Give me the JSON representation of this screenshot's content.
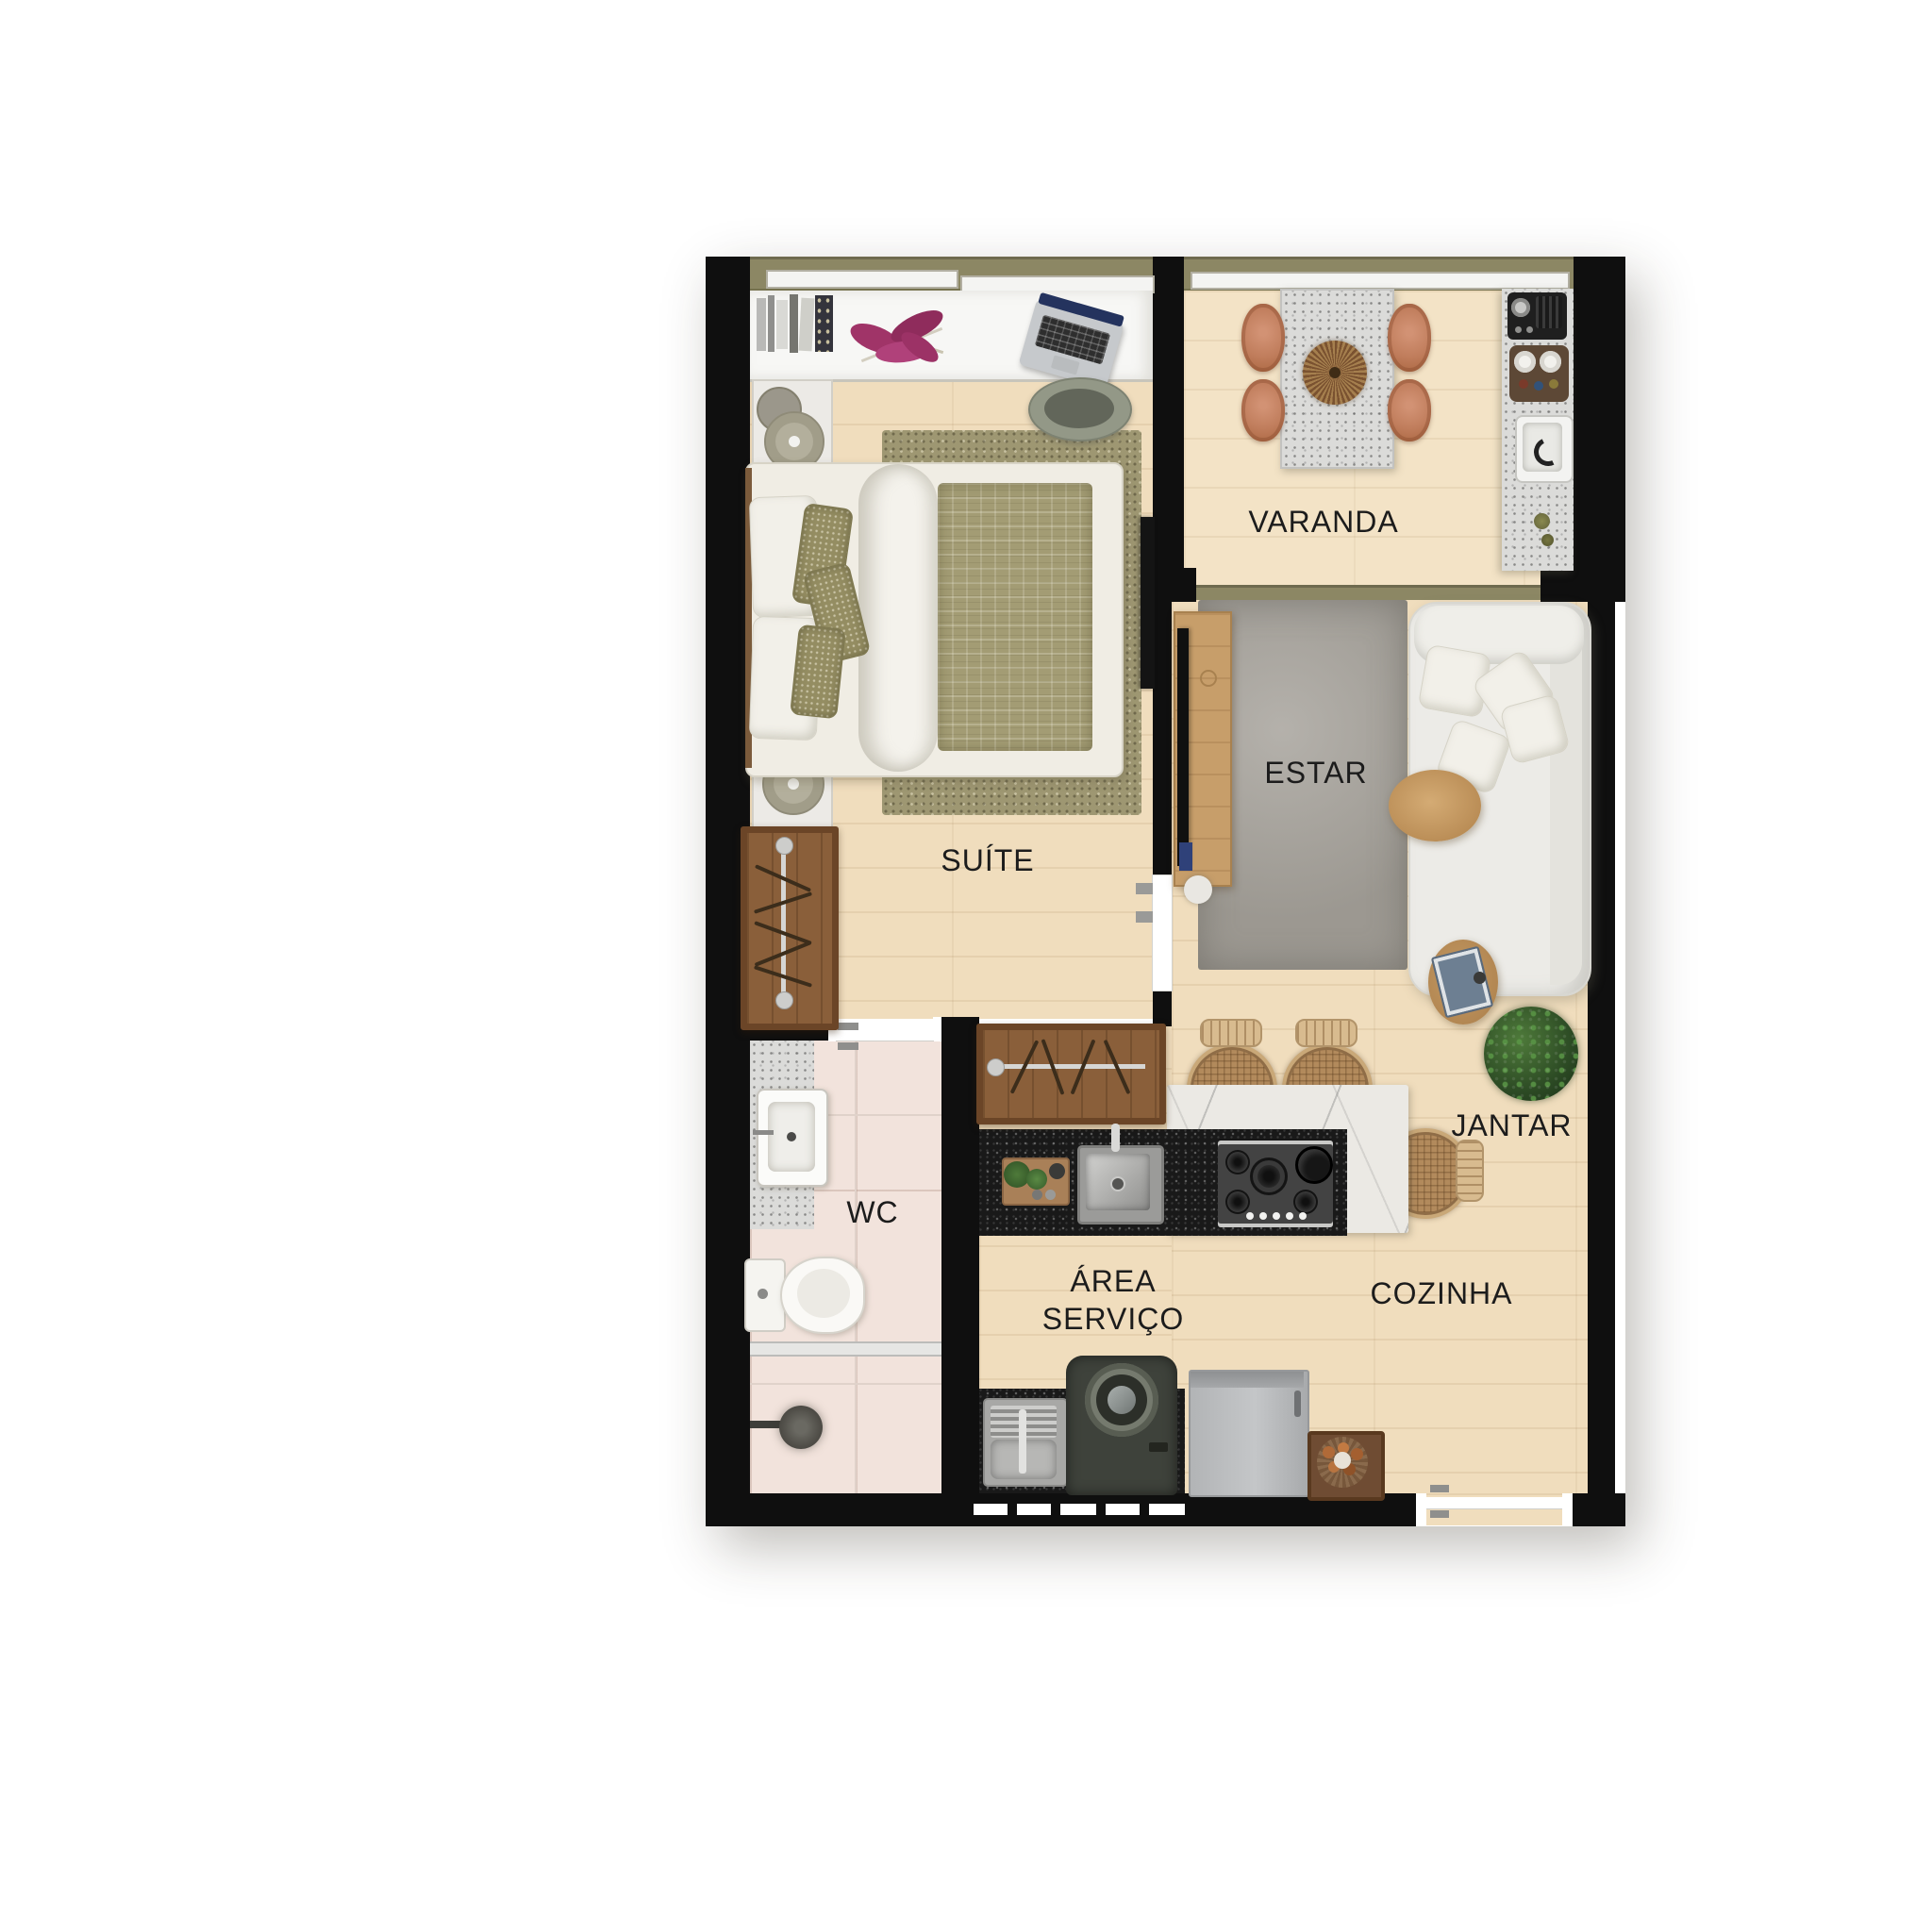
{
  "plan": {
    "type": "apartment-floor-plan",
    "orientation": "top-down",
    "background": "#ffffff"
  },
  "palette": {
    "wall": "#0f0f0f",
    "wood_floor": "#f0ddbd",
    "wood_floor_light": "#f3e3c6",
    "tile_floor": "#f2e3dc",
    "rug_gray": "#a6a29b",
    "rug_olive": "#9e9772",
    "counter_black": "#191919",
    "marble": "#ebe9e4",
    "granite": "#dbdbd9",
    "wardrobe_wood": "#8a5f3a",
    "furniture_wood": "#c79e6a",
    "sofa_white": "#ecebe7",
    "window_frame_olive": "#8c8764",
    "terracotta_chair": "#c07d5c",
    "label_color": "#1c1c1c"
  },
  "rooms": {
    "suite": {
      "label": "SUÍTE",
      "furniture": [
        "double-bed",
        "olive-area-rug",
        "desk-counter",
        "books",
        "flower-bouquet",
        "laptop",
        "desk-chair",
        "nightstand-lamps",
        "open-wardrobe",
        "wall-tv"
      ]
    },
    "varanda": {
      "label": "VARANDA",
      "furniture": [
        "granite-dining-table",
        "centerpiece",
        "terracotta-chairs",
        "grill-counter",
        "counter-sink"
      ]
    },
    "estar": {
      "label": "ESTAR",
      "furniture": [
        "sofa",
        "throw-pillows",
        "gray-rug",
        "oval-coffee-table",
        "side-table-with-book",
        "tv-console",
        "tv"
      ]
    },
    "wc": {
      "label": "WC",
      "furniture": [
        "granite-vanity",
        "basin-sink",
        "toilet",
        "glass-partition",
        "shower-head"
      ]
    },
    "jantar": {
      "label": "JANTAR",
      "furniture": [
        "rattan-counter-stools",
        "potted-plant"
      ]
    },
    "area_servico": {
      "label": "ÁREA SERVIÇO",
      "label_lines": [
        "ÁREA",
        "SERVIÇO"
      ],
      "furniture": [
        "laundry-tank-sink",
        "washing-machine",
        "black-counter"
      ]
    },
    "cozinha": {
      "label": "COZINHA",
      "furniture": [
        "island-black-counter",
        "marble-counter",
        "kitchen-sink",
        "cooktop",
        "cutting-board",
        "refrigerator",
        "fruit-basket"
      ]
    }
  }
}
